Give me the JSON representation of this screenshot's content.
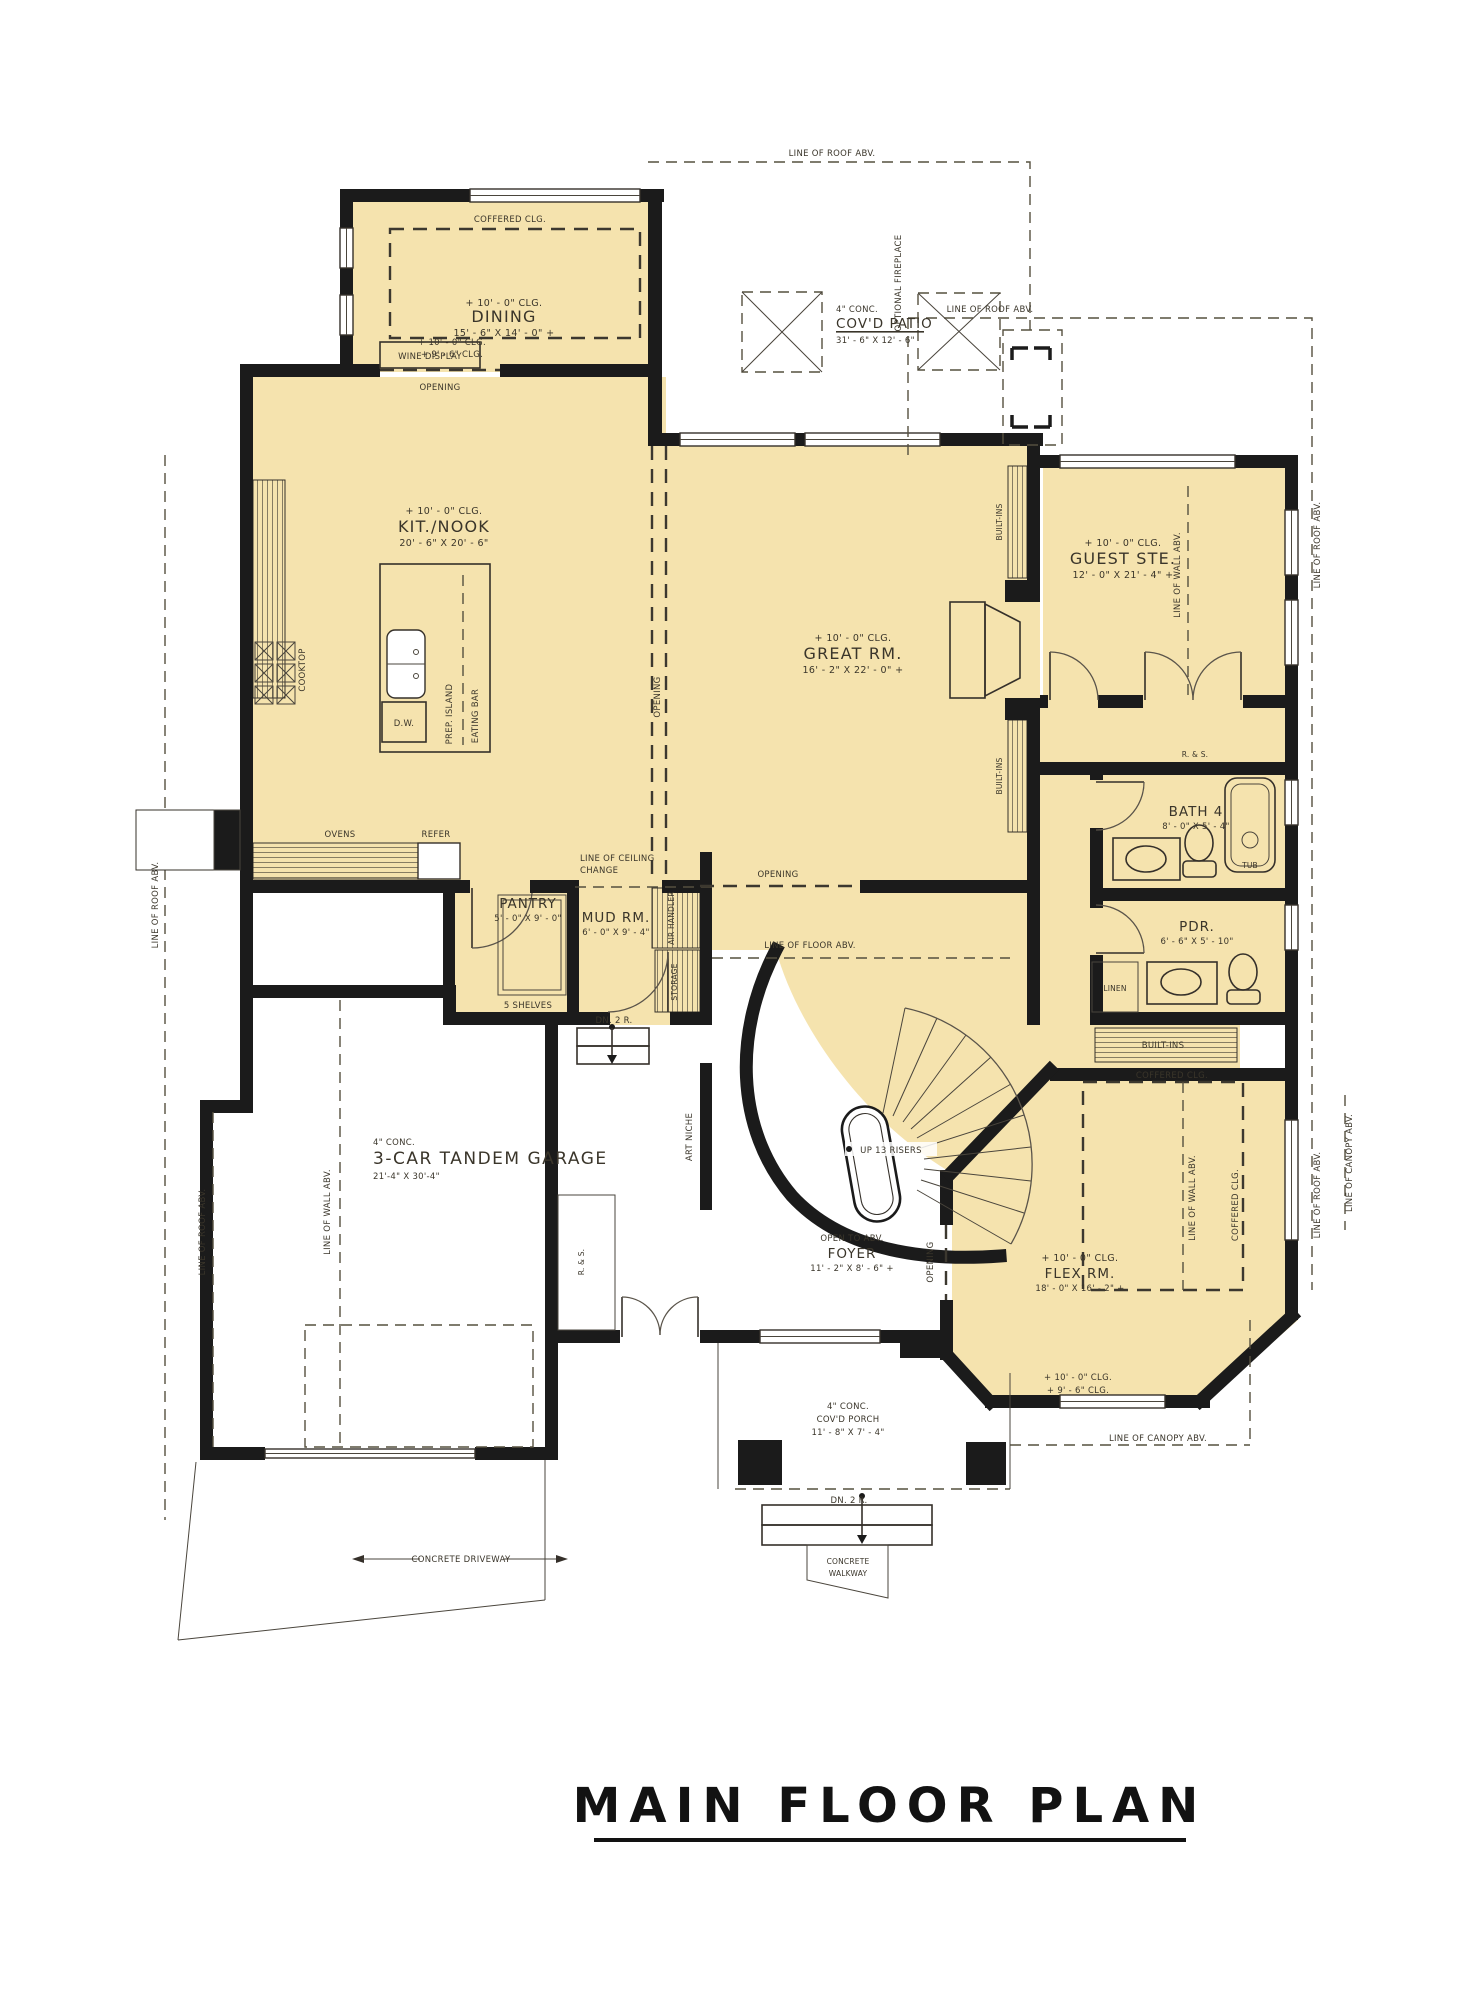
{
  "title": "MAIN FLOOR PLAN",
  "rooms": {
    "dining": {
      "ceil": "+ 10' - 0\" CLG.",
      "name": "DINING",
      "dims": "15' - 6\" X 14' - 0\" +"
    },
    "patio": {
      "conc": "4\" CONC.",
      "name": "COV'D PATIO",
      "dims": "31' - 6\" X 12' - 6\""
    },
    "kitchen": {
      "ceil": "+ 10' - 0\" CLG.",
      "name": "KIT./NOOK",
      "dims": "20' - 6\" X 20' - 6\""
    },
    "great": {
      "ceil": "+ 10' - 0\" CLG.",
      "name": "GREAT RM.",
      "dims": "16' - 2\" X 22' - 0\" +"
    },
    "guest": {
      "ceil": "+ 10' - 0\" CLG.",
      "name": "GUEST STE.",
      "dims": "12' - 0\" X 21' - 4\" +"
    },
    "bath4": {
      "name": "BATH 4",
      "dims": "8' - 0\" X 5' - 4\""
    },
    "pdr": {
      "name": "PDR.",
      "dims": "6' - 6\" X 5' - 10\""
    },
    "pantry": {
      "name": "PANTRY",
      "dims": "5' - 0\" X 9' - 0\"",
      "note": "5 SHELVES"
    },
    "mud": {
      "name": "MUD RM.",
      "dims": "6' - 0\" X 9' - 4\""
    },
    "garage": {
      "conc": "4\" CONC.",
      "name": "3-CAR TANDEM GARAGE",
      "dims": "21'-4\" X 30'-4\""
    },
    "foyer": {
      "open": "OPEN TO ABV.",
      "name": "FOYER",
      "dims": "11' - 2\" X 8' - 6\" +"
    },
    "flex": {
      "ceil": "+ 10' - 0\" CLG.",
      "name": "FLEX RM.",
      "dims": "18' - 0\" X 16' - 2\" +"
    },
    "porch": {
      "conc": "4\" CONC.",
      "name": "COV'D PORCH",
      "dims": "11' - 8\" X 7' - 4\""
    }
  },
  "annotations": {
    "coffered": "COFFERED CLG.",
    "roof_abv": "LINE OF ROOF ABV.",
    "wall_abv": "LINE OF WALL ABV.",
    "canopy_abv": "LINE OF CANOPY ABV.",
    "floor_abv": "LINE OF FLOOR ABV.",
    "ceil_change1": "LINE OF CEILING",
    "ceil_change2": "CHANGE",
    "opening": "OPENING",
    "optional_fireplace": "OPTIONAL FIREPLACE",
    "clg10": "+ 10' - 0\" CLG.",
    "clg96": "+ 9' - 6\" CLG.",
    "up_risers": "UP 13 RISERS",
    "dn2r": "DN. 2 R.",
    "driveway": "CONCRETE DRIVEWAY",
    "walkway1": "CONCRETE",
    "walkway2": "WALKWAY"
  },
  "fixtures": {
    "wine": "WINE DISPLAY",
    "cooktop": "COOKTOP",
    "ovens": "OVENS",
    "refer": "REFER",
    "dw": "D.W.",
    "prep": "PREP. ISLAND",
    "eating": "EATING BAR",
    "air": "AIR HANDLER",
    "storage": "STORAGE",
    "art": "ART NICHE",
    "builtins": "BUILT-INS",
    "rs": "R. & S.",
    "linen": "LINEN",
    "tub": "TUB"
  },
  "colors": {
    "room_fill": "#f5e3ae",
    "wall": "#1b1b1b",
    "dash": "#55503f"
  }
}
